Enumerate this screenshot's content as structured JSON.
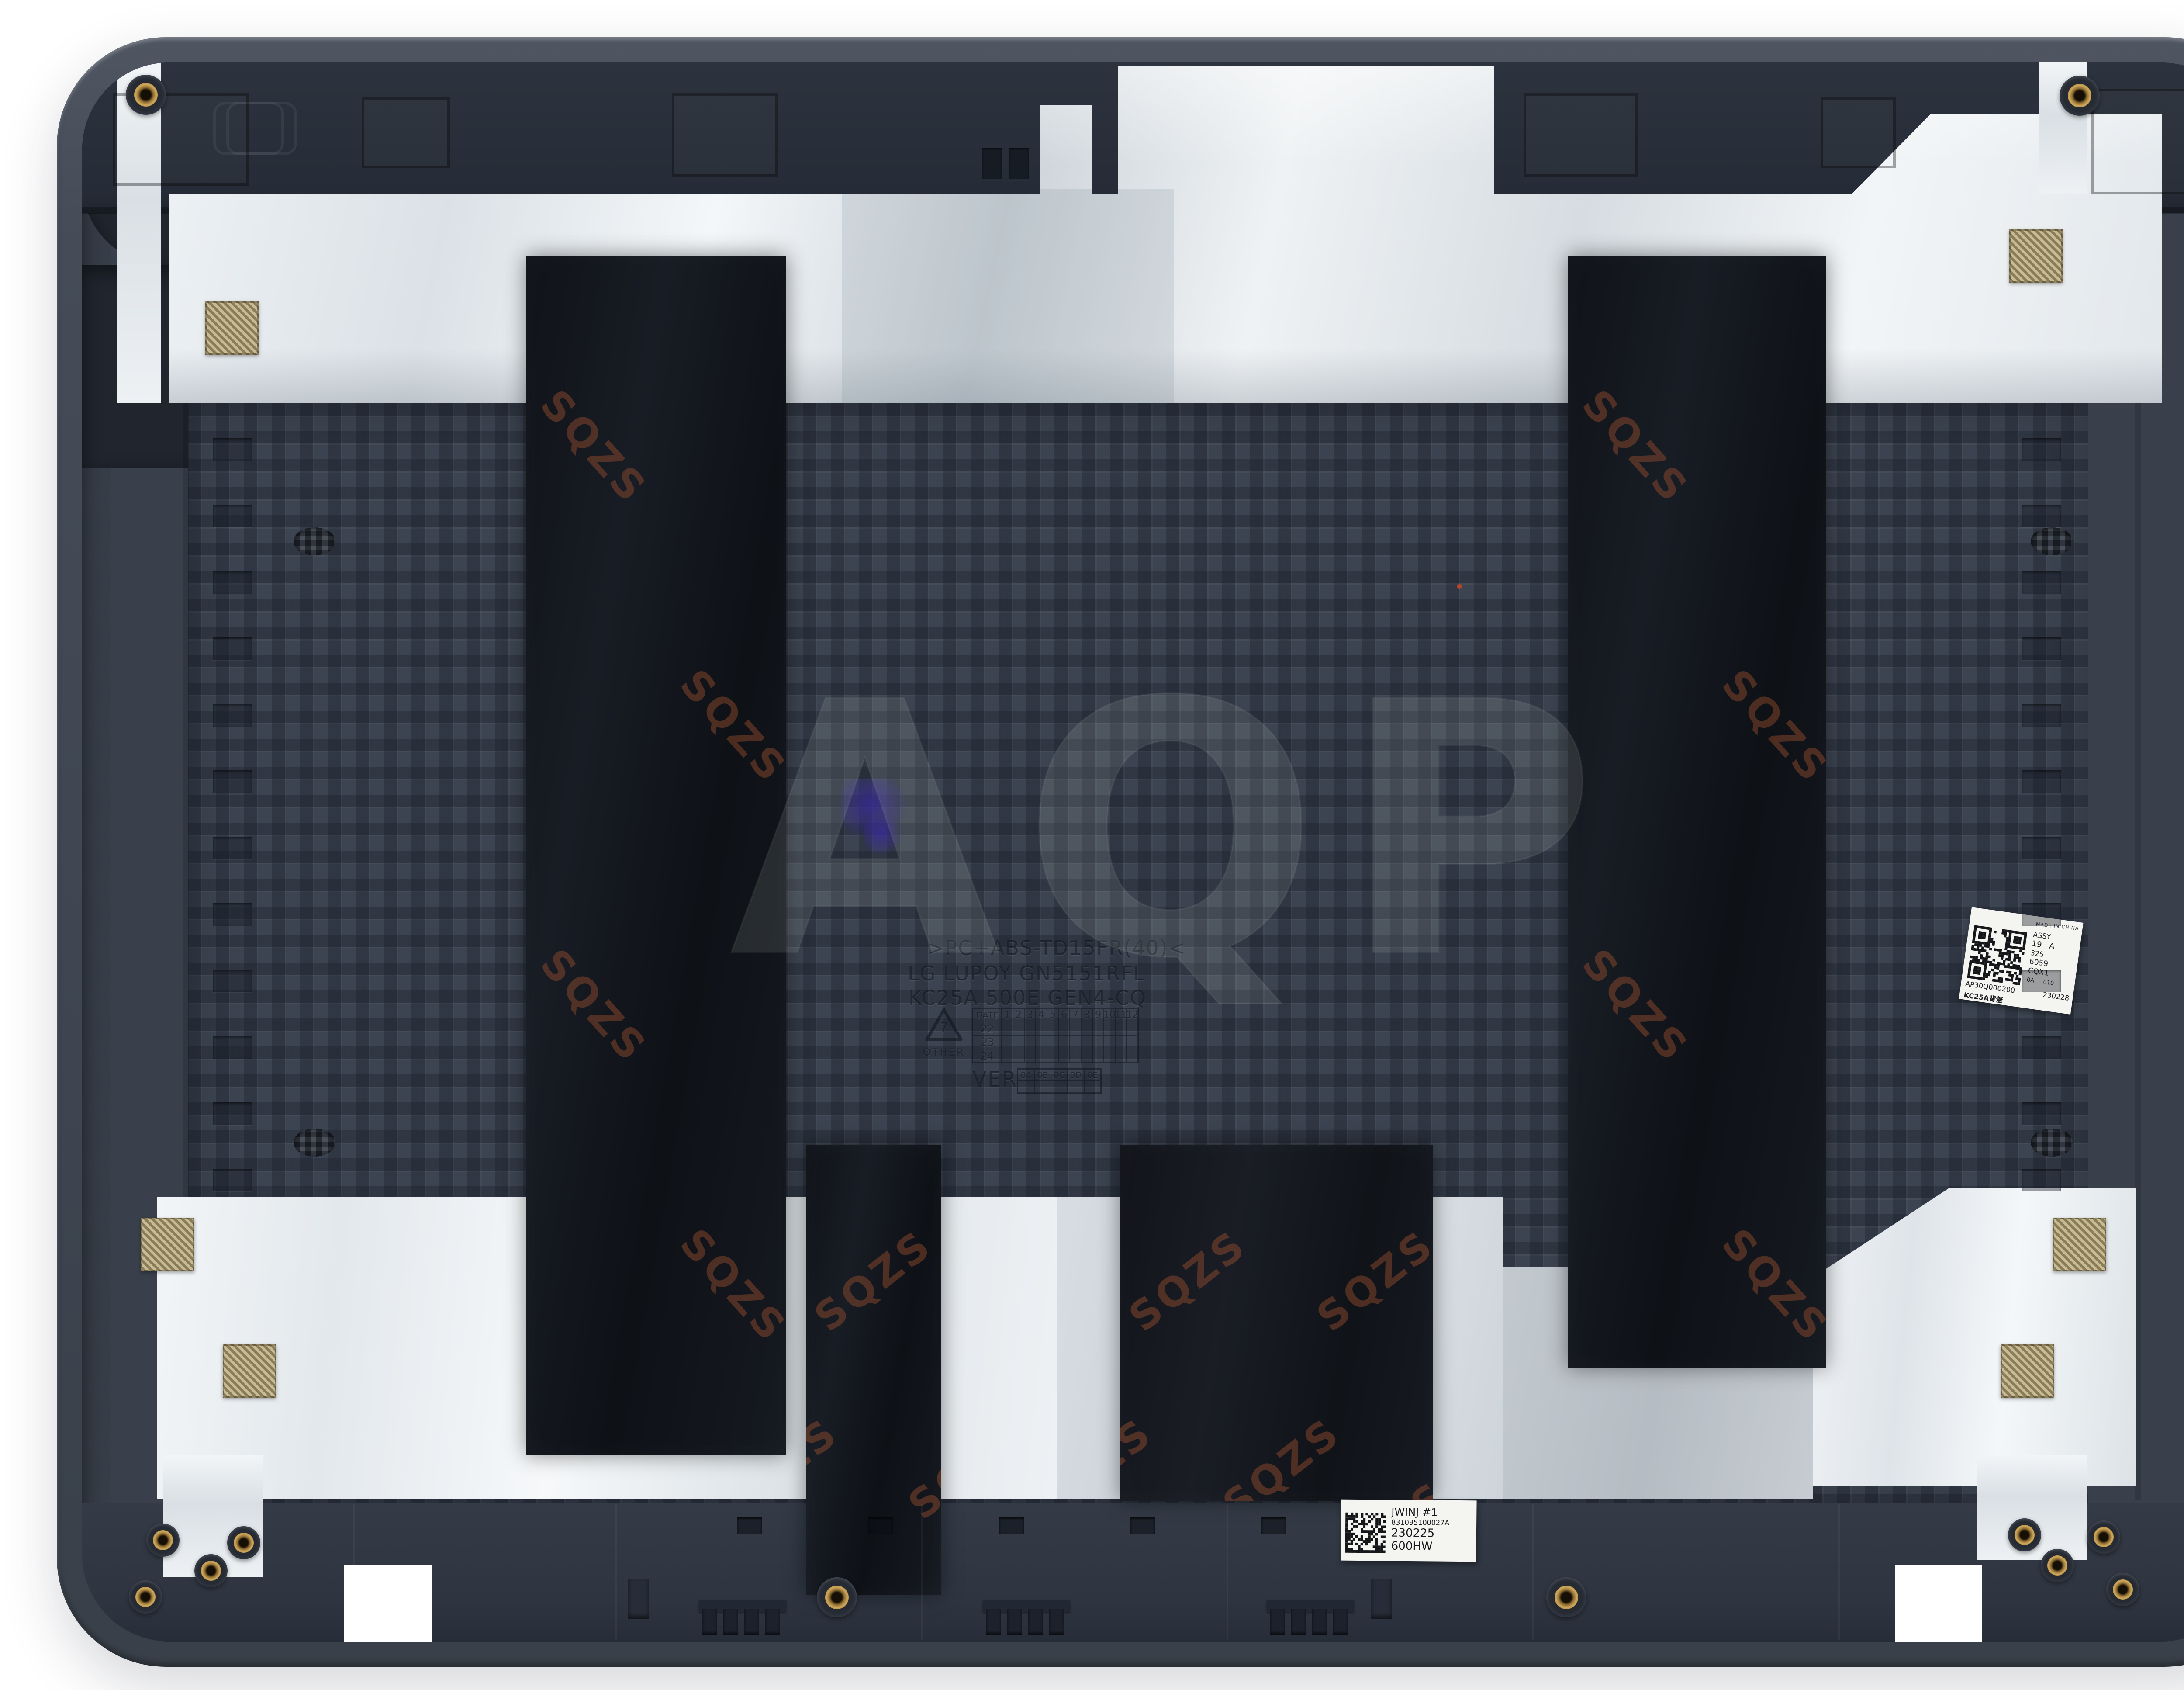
{
  "image_type": "product photo of laptop LCD back cover (inside view)",
  "colors": {
    "background": "#ffffff",
    "rim_plastic": "#454c58",
    "shell_plastic": "#39404b",
    "top_band": "#2c333e",
    "texture_base": "#3c4451",
    "foil_bright": "#eef2f5",
    "foil_dim": "#c9d0d6",
    "mylar_black": "#14171d",
    "watermark_rust": "#a4542f",
    "brass_insert": "#cfa85c",
    "gold_pad": "#b3a478",
    "sticker_white": "#f4f4f1",
    "ink_blue": "#382c94"
  },
  "molded_text": {
    "material_line": ">PC+ABS-TD15FR(40)<",
    "resin_line": "LG LUPOY GN5151RFL",
    "model_line": "KC25A 500E GEN4-CQ",
    "recycle_code": "7",
    "recycle_label": "OTHER",
    "date_grid": {
      "corner_label": "DATE",
      "months": [
        "1",
        "2",
        "3",
        "4",
        "5",
        "6",
        "7",
        "8",
        "9",
        "10",
        "11",
        "12"
      ],
      "years": [
        "22",
        "23",
        "24"
      ]
    },
    "ver_label": "VER",
    "ver_cells": [
      "0A",
      "0B",
      "0C",
      "0D",
      "0E"
    ]
  },
  "sticker_right": {
    "origin": "MADE IN CHINA",
    "assy": "ASSY",
    "rev_left": "19",
    "rev_right": "A",
    "code1": "32S",
    "code2": "6059",
    "code3": "CQX1",
    "code4_left": "0A",
    "code4_right": "010",
    "part_number": "AP30Q000200",
    "date_code": "230228",
    "model": "KC25A背蓋"
  },
  "sticker_bottom": {
    "station": "JWINJ #1",
    "serial": "831095100027A",
    "date_code": "230225",
    "code": "600HW"
  },
  "watermarks": {
    "center_logo": "AQP",
    "tape_text": "SQZS"
  }
}
